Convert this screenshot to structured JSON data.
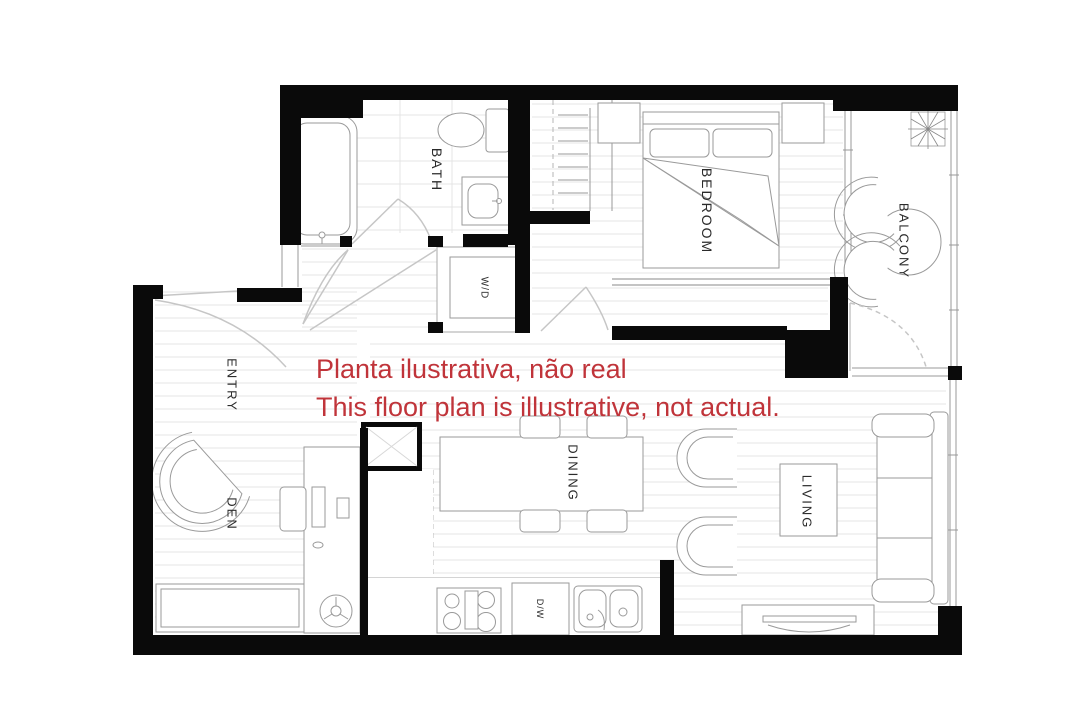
{
  "title": "Apartment floor plan",
  "disclaimer": {
    "line1": "Planta ilustrativa, não real",
    "line2": "This floor plan is illustrative, not actual.",
    "color": "#c0343a"
  },
  "labels": {
    "bath": "BATH",
    "bedroom": "BEDROOM",
    "balcony": "BALCONY",
    "entry": "ENTRY",
    "den": "DEN",
    "dining": "DINING",
    "living": "LIVING",
    "washer_dryer": "W/D",
    "dishwasher": "D/W"
  },
  "colors": {
    "wall": "#0a0a0a",
    "fixture_line": "#9a9a9a",
    "floor_line": "#e4e4e4",
    "door_line": "#c6c6c6",
    "label_text": "#2b2b2b",
    "disclaimer_red": "#c0343a"
  }
}
